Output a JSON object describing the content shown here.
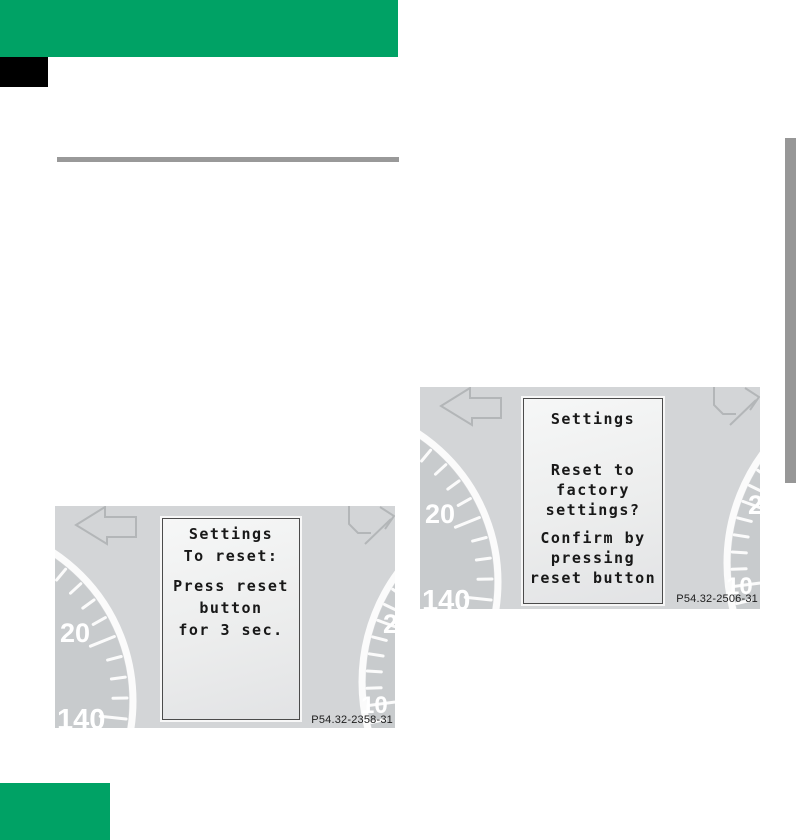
{
  "figure1": {
    "caption_code": "P54.32-2358-31",
    "display_lines": [
      "Settings",
      "To reset:",
      "Press reset",
      "button",
      "for 3 sec."
    ]
  },
  "figure2": {
    "caption_code": "P54.32-2506-31",
    "display_lines": [
      "Settings",
      "Reset to",
      "factory",
      "settings?",
      "Confirm by",
      "pressing",
      "reset button"
    ]
  },
  "cluster": {
    "speedometer_labels": [
      "20",
      "140"
    ],
    "tachometer_labels": [
      "2",
      "10"
    ]
  },
  "colors": {
    "accent_green": "#00a265",
    "divider_gray": "#999999",
    "edge_tab_gray": "#979797",
    "cluster_background": "#d3d5d7",
    "dial_face": "#c8cbcd",
    "display_text": "#181818",
    "gauge_markings": "#fbfbfb"
  }
}
